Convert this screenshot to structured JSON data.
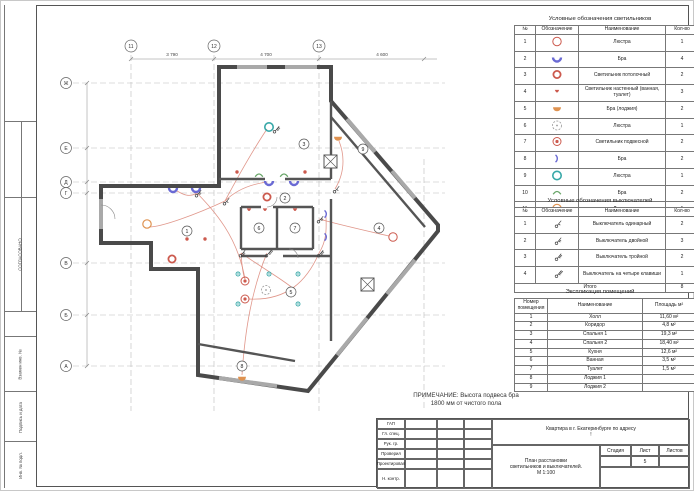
{
  "colors": {
    "wall": "#4a4a4a",
    "window": "#a9a9a9",
    "grid": "#bcbcbc",
    "wiring": "#dd8b7d",
    "red": "#cc5a4e",
    "blue": "#6a6ad4",
    "teal": "#38a8a8",
    "orange": "#df9250",
    "green": "#67a567",
    "gray": "#999999"
  },
  "side_strip": {
    "agreed": "СОГЛАСОВАНО",
    "cells": [
      "Взамен инв. №",
      "Подпись и дата",
      "Инв. № подл."
    ]
  },
  "note": {
    "line1": "ПРИМЕЧАНИЕ: Высота подвеса бра",
    "line2": "1800 мм от чистого пола"
  },
  "legend_lights": {
    "title": "Условные обозначения светильников",
    "headers": [
      "№",
      "Обозначение",
      "Наименование",
      "Кол-во"
    ],
    "rows": [
      {
        "n": "1",
        "symbol": "circle-red-outline",
        "name": "Люстра",
        "qty": "1"
      },
      {
        "n": "2",
        "symbol": "bra-blue",
        "name": "Бра",
        "qty": "4"
      },
      {
        "n": "3",
        "symbol": "circle-red-thick",
        "name": "Светильник потолочный",
        "qty": "2"
      },
      {
        "n": "4",
        "symbol": "wall-red-small",
        "name": "Светильник настенный (ванная, туалет)",
        "qty": "3"
      },
      {
        "n": "5",
        "symbol": "half-orange",
        "name": "Бра (лоджия)",
        "qty": "2"
      },
      {
        "n": "6",
        "symbol": "circle-dashed",
        "name": "Люстра",
        "qty": "1"
      },
      {
        "n": "7",
        "symbol": "circle-red-dot",
        "name": "Светильник подвесной",
        "qty": "2"
      },
      {
        "n": "8",
        "symbol": "arc-blue",
        "name": "Бра",
        "qty": "2"
      },
      {
        "n": "9",
        "symbol": "circle-teal",
        "name": "Люстра",
        "qty": "1"
      },
      {
        "n": "10",
        "symbol": "arc-green",
        "name": "Бра",
        "qty": "2"
      },
      {
        "n": "11",
        "symbol": "circle-orange",
        "name": "Люстра",
        "qty": "1"
      },
      {
        "n": "12",
        "symbol": "dot-red",
        "name": "Подсветка шкафов-купе",
        "qty": "4"
      },
      {
        "n": "13",
        "symbol": "dot-teal",
        "name": "Точечный светильник",
        "qty": "5"
      }
    ],
    "total_label": "Итого",
    "total": "30"
  },
  "legend_switches": {
    "title": "Условные обозначения выключателей",
    "headers": [
      "№",
      "Обозначение",
      "Наименование",
      "Кол-во"
    ],
    "rows": [
      {
        "n": "1",
        "symbol": "switch-1",
        "name": "Выключатель одинарный",
        "qty": "2"
      },
      {
        "n": "2",
        "symbol": "switch-2",
        "name": "Выключатель двойной",
        "qty": "3"
      },
      {
        "n": "3",
        "symbol": "switch-3",
        "name": "Выключатель тройной",
        "qty": "2"
      },
      {
        "n": "4",
        "symbol": "switch-4",
        "name": "Выключатель на четыре клавиши",
        "qty": "1"
      }
    ],
    "total_label": "Итого",
    "total": "8"
  },
  "explication": {
    "title": "Экспликация помещений",
    "headers": [
      "Номер помещения",
      "Наименование",
      "Площадь м²"
    ],
    "rows": [
      {
        "n": "1",
        "name": "Холл",
        "area": "11,60 м²"
      },
      {
        "n": "2",
        "name": "Коридор",
        "area": "4,8 м²"
      },
      {
        "n": "3",
        "name": "Спальня 1",
        "area": "19,3 м²"
      },
      {
        "n": "4",
        "name": "Спальня 2",
        "area": "18,40 м²"
      },
      {
        "n": "5",
        "name": "Кухня",
        "area": "12,6 м²"
      },
      {
        "n": "6",
        "name": "Ванная",
        "area": "3,5 м²"
      },
      {
        "n": "7",
        "name": "Туалет",
        "area": "1,5 м²"
      },
      {
        "n": "8",
        "name": "Лоджия 1",
        "area": ""
      },
      {
        "n": "9",
        "name": "Лоджия 2",
        "area": ""
      }
    ]
  },
  "title_block": {
    "signature_rows": [
      "ГАП",
      "Гл. спец.",
      "Рук. гр.",
      "Проверил",
      "Проектировал",
      "Н. контр."
    ],
    "project": "Квартира в г. Екатеринбурге по адресу",
    "project_line2": "!",
    "doc_line1": "План расстановки",
    "doc_line2": "светильников и выключателей.",
    "doc_line3": "М 1:100",
    "stage_label": "Стадия",
    "sheet_label": "Лист",
    "sheets_label": "Листов",
    "sheet_no": "5"
  },
  "plan": {
    "grid_cols": [
      {
        "label": "11",
        "x": 94
      },
      {
        "label": "12",
        "x": 177
      },
      {
        "label": "13",
        "x": 282
      }
    ],
    "grid_rows": [
      {
        "label": "Ж",
        "y": 74
      },
      {
        "label": "Е",
        "y": 139
      },
      {
        "label": "Д",
        "y": 173
      },
      {
        "label": "Г",
        "y": 184
      },
      {
        "label": "В",
        "y": 254
      },
      {
        "label": "Б",
        "y": 306
      },
      {
        "label": "А",
        "y": 357
      }
    ],
    "dims_top": [
      {
        "label": "3 790",
        "x": 135
      },
      {
        "label": "4 700",
        "x": 229
      },
      {
        "label": "4 600",
        "x": 345
      }
    ],
    "rooms": [
      {
        "n": "1",
        "x": 150,
        "y": 222
      },
      {
        "n": "2",
        "x": 248,
        "y": 189
      },
      {
        "n": "3",
        "x": 267,
        "y": 135
      },
      {
        "n": "4",
        "x": 342,
        "y": 219
      },
      {
        "n": "5",
        "x": 254,
        "y": 283
      },
      {
        "n": "6",
        "x": 222,
        "y": 219
      },
      {
        "n": "7",
        "x": 258,
        "y": 219
      },
      {
        "n": "8",
        "x": 205,
        "y": 357
      },
      {
        "n": "9",
        "x": 326,
        "y": 140
      }
    ],
    "symbols": [
      {
        "t": "circle-teal",
        "x": 232,
        "y": 118
      },
      {
        "t": "bra-blue",
        "x": 136,
        "y": 180
      },
      {
        "t": "bra-blue",
        "x": 159,
        "y": 180
      },
      {
        "t": "bra-blue",
        "x": 232,
        "y": 173
      },
      {
        "t": "bra-blue",
        "x": 257,
        "y": 173
      },
      {
        "t": "arc-green",
        "x": 222,
        "y": 166
      },
      {
        "t": "arc-green",
        "x": 247,
        "y": 166
      },
      {
        "t": "arc-blue",
        "x": 289,
        "y": 205
      },
      {
        "t": "arc-blue",
        "x": 289,
        "y": 228
      },
      {
        "t": "circle-red-dot",
        "x": 208,
        "y": 272
      },
      {
        "t": "circle-red-dot",
        "x": 208,
        "y": 290
      },
      {
        "t": "circle-dashed",
        "x": 229,
        "y": 281
      },
      {
        "t": "dot-teal",
        "x": 201,
        "y": 265
      },
      {
        "t": "dot-teal",
        "x": 232,
        "y": 265
      },
      {
        "t": "dot-teal",
        "x": 261,
        "y": 265
      },
      {
        "t": "dot-teal",
        "x": 261,
        "y": 295
      },
      {
        "t": "dot-teal",
        "x": 201,
        "y": 295
      },
      {
        "t": "circle-orange",
        "x": 110,
        "y": 215
      },
      {
        "t": "circle-red-outline",
        "x": 356,
        "y": 228
      },
      {
        "t": "circle-red-thick",
        "x": 230,
        "y": 188
      },
      {
        "t": "circle-red-thick",
        "x": 135,
        "y": 250
      },
      {
        "t": "wall-red-small",
        "x": 212,
        "y": 201
      },
      {
        "t": "wall-red-small",
        "x": 228,
        "y": 201
      },
      {
        "t": "wall-red-small",
        "x": 258,
        "y": 201
      },
      {
        "t": "half-orange",
        "x": 205,
        "y": 369
      },
      {
        "t": "half-orange",
        "x": 301,
        "y": 129
      },
      {
        "t": "dot-red",
        "x": 150,
        "y": 230
      },
      {
        "t": "dot-red",
        "x": 168,
        "y": 230
      },
      {
        "t": "dot-red",
        "x": 200,
        "y": 163
      },
      {
        "t": "dot-red",
        "x": 268,
        "y": 163
      },
      {
        "t": "switch-1",
        "x": 188,
        "y": 192
      },
      {
        "t": "switch-1",
        "x": 298,
        "y": 180
      },
      {
        "t": "switch-2",
        "x": 160,
        "y": 184
      },
      {
        "t": "switch-2",
        "x": 204,
        "y": 244
      },
      {
        "t": "switch-2",
        "x": 282,
        "y": 210
      },
      {
        "t": "switch-3",
        "x": 282,
        "y": 244
      },
      {
        "t": "switch-3",
        "x": 238,
        "y": 120
      },
      {
        "t": "switch-4",
        "x": 230,
        "y": 244
      }
    ]
  }
}
